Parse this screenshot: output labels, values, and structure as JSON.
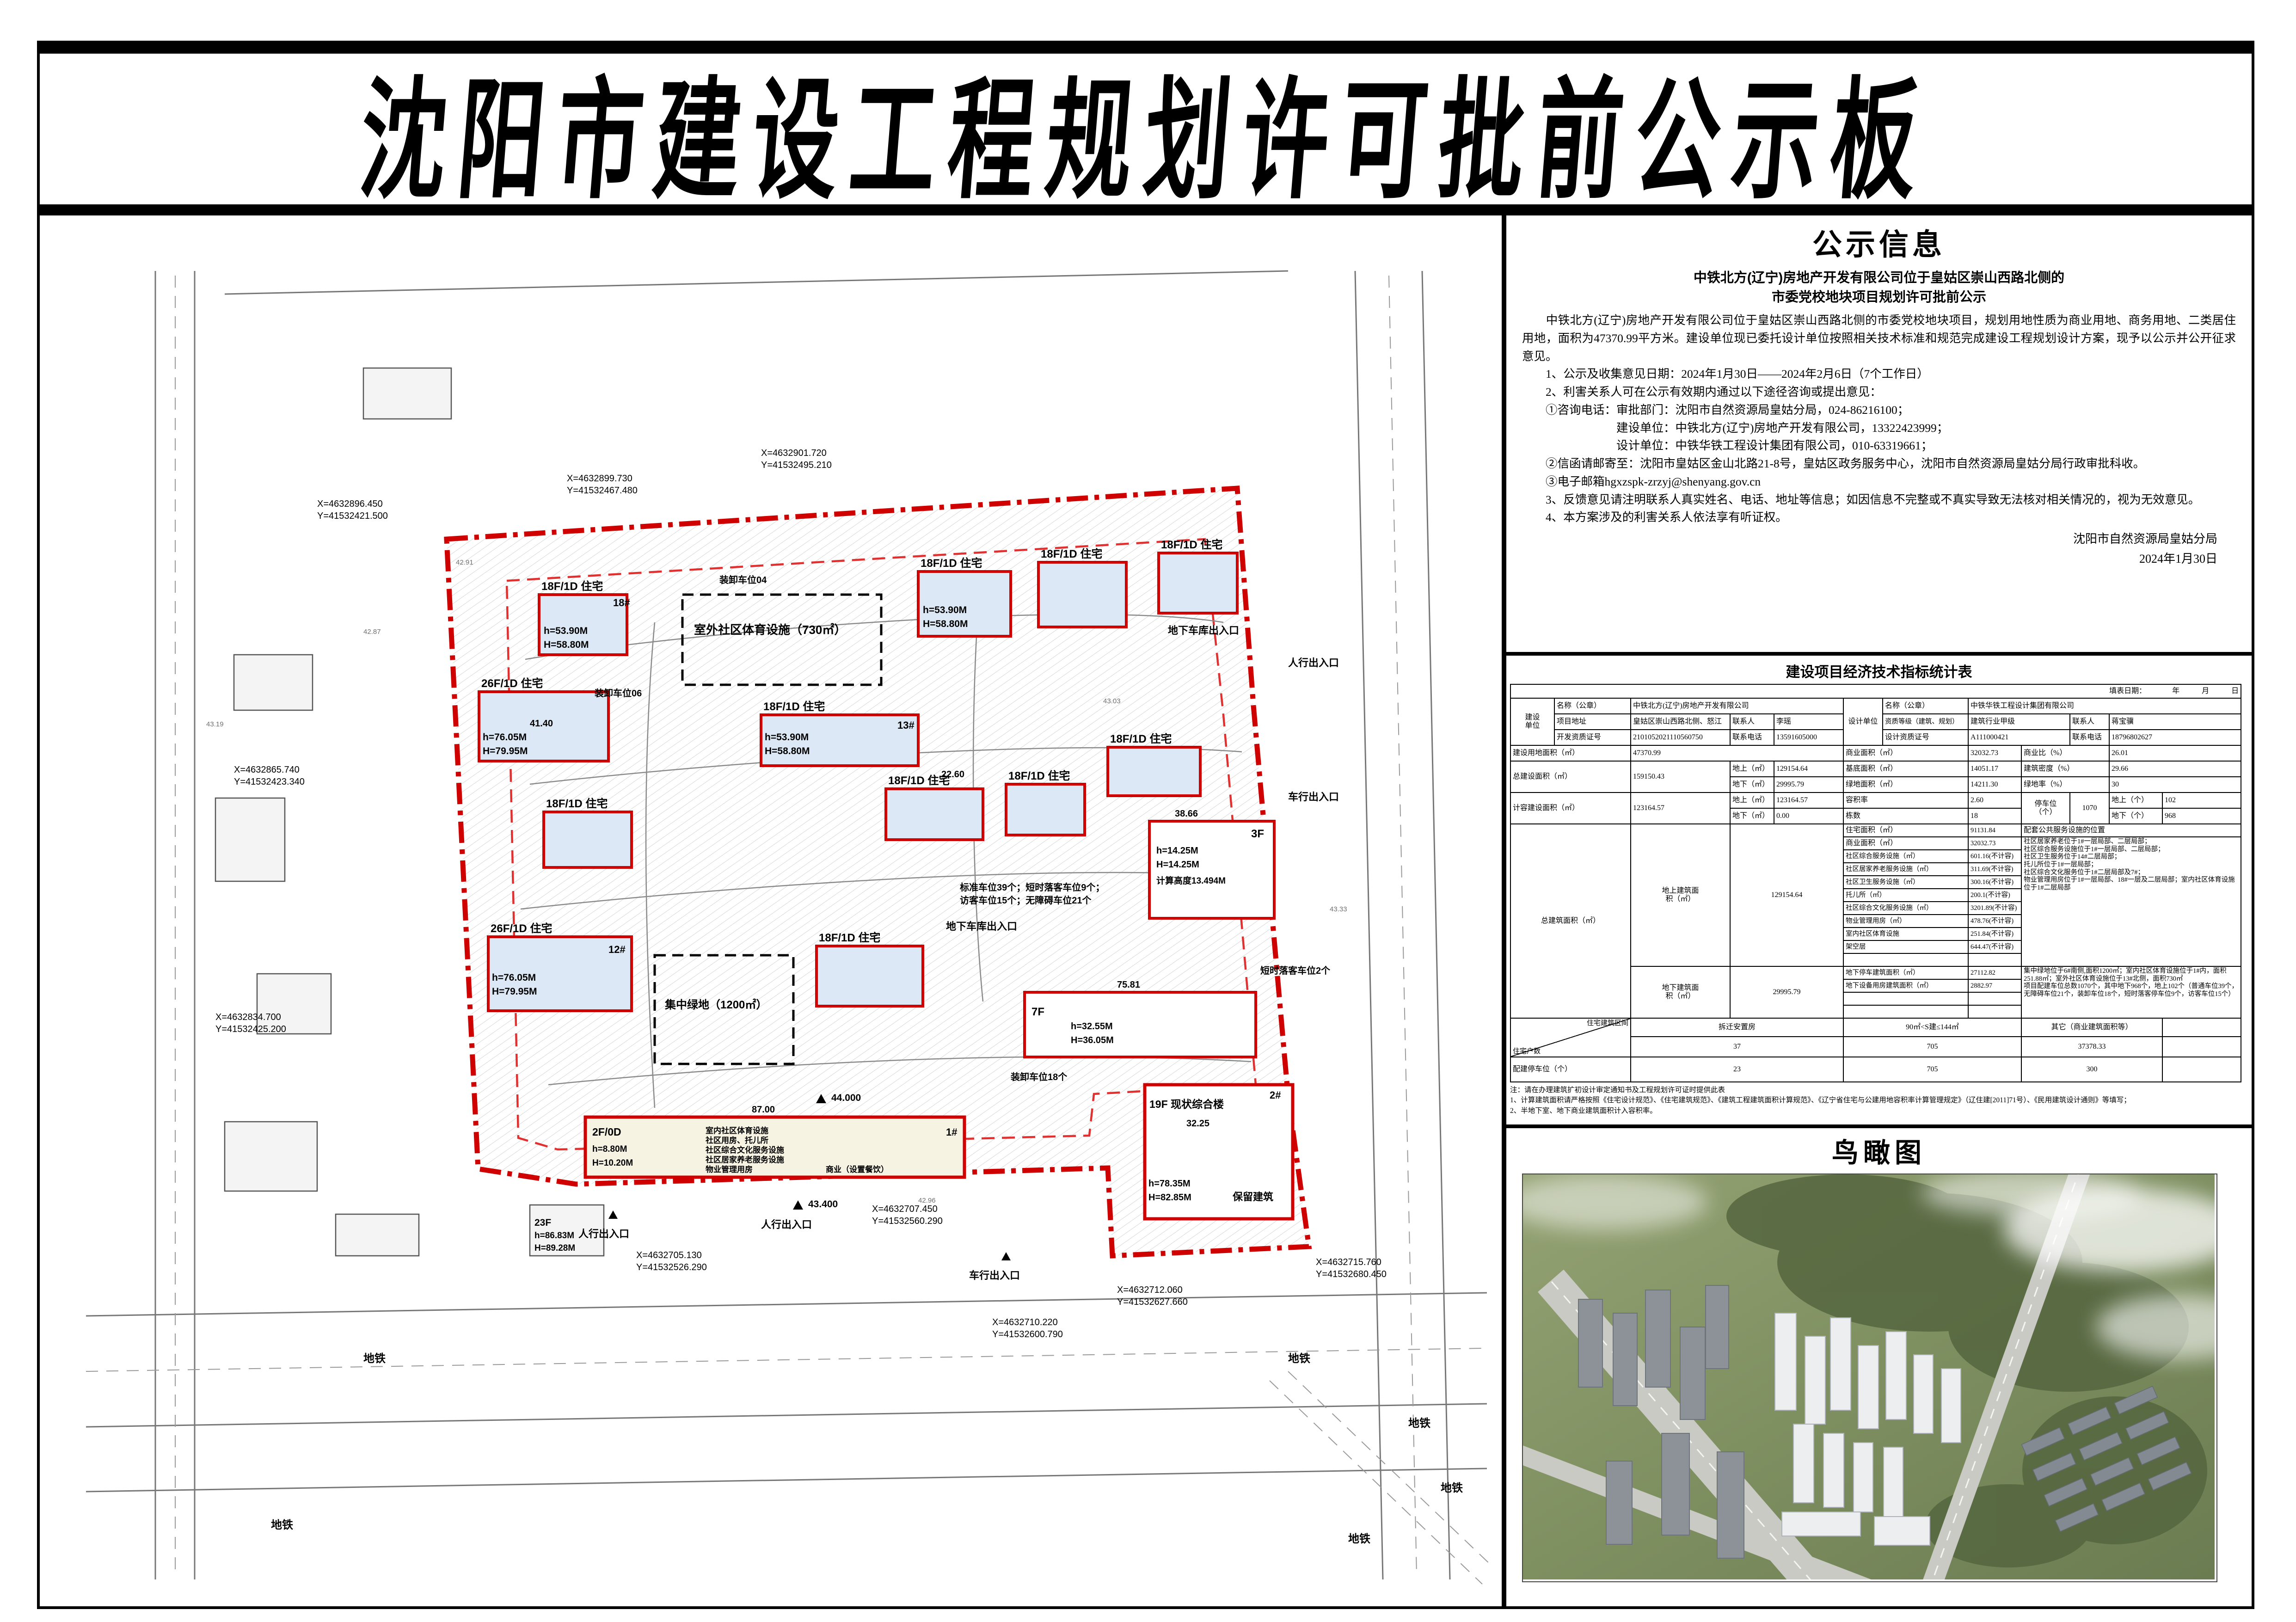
{
  "page": {
    "title": "沈阳市建设工程规划许可批前公示板"
  },
  "notice": {
    "title": "公示信息",
    "subtitle1": "中铁北方(辽宁)房地产开发有限公司位于皇姑区崇山西路北侧的",
    "subtitle2": "市委党校地块项目规划许可批前公示",
    "paragraphs": [
      "　　中铁北方(辽宁)房地产开发有限公司位于皇姑区崇山西路北侧的市委党校地块项目，规划用地性质为商业用地、商务用地、二类居住用地，面积为47370.99平方米。建设单位现已委托设计单位按照相关技术标准和规范完成建设工程规划设计方案，现予以公示并公开征求意见。",
      "　　1、公示及收集意见日期：2024年1月30日——2024年2月6日（7个工作日）",
      "　　2、利害关系人可在公示有效期内通过以下途径咨询或提出意见：",
      "　　①咨询电话：审批部门：沈阳市自然资源局皇姑分局，024-86216100；",
      "　　　　　　　　建设单位：中铁北方(辽宁)房地产开发有限公司，13322423999；",
      "　　　　　　　　设计单位：中铁华铁工程设计集团有限公司，010-63319661；",
      "　　②信函请邮寄至：沈阳市皇姑区金山北路21-8号，皇姑区政务服务中心，沈阳市自然资源局皇姑分局行政审批科收。",
      "　　③电子邮箱hgxzspk-zrzyj@shenyang.gov.cn",
      "　　3、反馈意见请注明联系人真实姓名、电话、地址等信息；如因信息不完整或不真实导致无法核对相关情况的，视为无效意见。",
      "　　4、本方案涉及的利害关系人依法享有听证权。"
    ],
    "signature": "沈阳市自然资源局皇姑分局",
    "date": "2024年1月30日"
  },
  "table": {
    "title": "建设项目经济技术指标统计表",
    "fill_date": "填表日期：　　　　年　　　月　　　日",
    "builder": {
      "label": "建设\n单位",
      "name_label": "名称（公章）",
      "name": "中铁北方(辽宁)房地产开发有限公司",
      "addr_label": "项目地址",
      "addr": "皇姑区崇山西路北侧、怒江",
      "contact_label": "联系人",
      "contact": "李瑶",
      "cert_label": "开发资质证号",
      "cert": "2101052021110560750",
      "phone_label": "联系电话",
      "phone": "13591605000"
    },
    "designer": {
      "label": "设计单位",
      "name_label": "名称（公章）",
      "name": "中铁华铁工程设计集团有限公司",
      "grade_label": "资质等级（建筑、规划）",
      "grade": "建筑行业甲级",
      "contact_label": "联系人",
      "contact": "蒋宝骥",
      "cert_label": "设计资质证号",
      "cert": "A111000421",
      "phone_label": "联系电话",
      "phone": "18796802627"
    },
    "land": {
      "label": "建设用地面积（㎡）",
      "value": "47370.99",
      "biz_label": "商业面积（㎡）",
      "biz": "32032.73",
      "ratio_label": "商业比（%）",
      "ratio": "26.01"
    },
    "total": {
      "label": "总建设面积（㎡）",
      "value": "159150.43",
      "up_label": "地上（㎡）",
      "up": "129154.64",
      "base_label": "基底面积（㎡）",
      "base": "14051.17",
      "density_label": "建筑密度（%）",
      "density": "29.66",
      "down_label": "地下（㎡）",
      "down": "29995.79",
      "green_label": "绿地面积（㎡）",
      "green": "14211.30",
      "green_rate_label": "绿地率（%）",
      "green_rate": "30"
    },
    "frc": {
      "label": "计容建设面积（㎡）",
      "value": "123164.57",
      "up_label": "地上（㎡）",
      "up": "123164.57",
      "far_label": "容积率",
      "far": "2.60",
      "park_label": "停车位\n（个）",
      "park": "1070",
      "pu_label": "地上（个）",
      "pu": "102",
      "down_label": "地下（㎡）",
      "down": "0.00",
      "cnt_label": "栋数",
      "cnt": "18",
      "pd_label": "地下（个）",
      "pd": "968"
    },
    "gfa": {
      "label": "总建筑面积（㎡）",
      "above_label": "地上建筑面\n积（㎡）",
      "above": "129154.64",
      "below_label": "地下建筑面\n积（㎡）",
      "below": "29995.79"
    },
    "above_items": [
      {
        "n": "住宅面积（㎡）",
        "v": "91131.84"
      },
      {
        "n": "商业面积（㎡）",
        "v": "32032.73"
      },
      {
        "n": "社区综合服务设施（㎡）",
        "v": "601.16(不计容)"
      },
      {
        "n": "社区居家养老服务设施（㎡）",
        "v": "311.69(不计容)"
      },
      {
        "n": "社区卫生服务设施（㎡）",
        "v": "300.16(不计容)"
      },
      {
        "n": "托儿所（㎡）",
        "v": "200.1(不计容)"
      },
      {
        "n": "社区综合文化服务设施（㎡）",
        "v": "3201.89(不计容)"
      },
      {
        "n": "物业管理用房（㎡）",
        "v": "478.76(不计容)"
      },
      {
        "n": "室内社区体育设施",
        "v": "251.84(不计容)"
      },
      {
        "n": "架空层",
        "v": "644.47(不计容)"
      },
      {
        "n": "",
        "v": ""
      }
    ],
    "below_items": [
      {
        "n": "地下停车建筑面积（㎡）",
        "v": "27112.82"
      },
      {
        "n": "地下设备用房建筑面积（㎡）",
        "v": "2882.97"
      },
      {
        "n": "",
        "v": ""
      },
      {
        "n": "",
        "v": ""
      }
    ],
    "services_title": "配套公共服务设施的位置",
    "services_text1": "社区居家养老位于1#一层局部、二层局部；\n社区综合服务设施位于1#一层局部、二层局部；\n社区卫生服务位于14#二层局部；\n托儿所位于1#一层局部；\n社区综合文化服务位于1#二层局部及7#；\n物业管理用房位于1#一层局部、18#一层及二层局部；室内社区体育设施位于1#二层局部",
    "services_text2": "集中绿地位于6#南侧,面积1200㎡；室内社区体育设施位于1#内，面积251.88㎡；室外社区体育设施位于13#北侧，面积730㎡\n项目配建车位总数1070个，其中地下968个，地上102个（普通车位39个，无障碍车位21个，装卸车位18个，短时落客停车位9个，访客车位15个）",
    "bottom": {
      "hu_label": "住宅户数",
      "qujian_label": "住宅建筑区间",
      "chaiqian": "拆迁安置房",
      "range": "90㎡<S建≤144㎡",
      "other": "其它（商业建筑面积等）",
      "hu_v1": "37",
      "hu_v2": "705",
      "hu_v3": "37378.33",
      "park_label": "配建停车位（个）",
      "pk_v1": "23",
      "pk_v2": "705",
      "pk_v3": "300"
    },
    "notes": "注：请在办理建筑扩初设计审定通知书及工程规划许可证时提供此表\n1、计算建筑面积请严格按照《住宅设计规范》、《住宅建筑规范》、《建筑工程建筑面积计算规范》、《辽宁省住宅与公建用地容积率计算管理规定》（辽住建[2011]71号）、《民用建筑设计通则》等填写；\n2、半地下室、地下商业建筑面积计入容积率。"
  },
  "plan": {
    "b18": "18F/1D 住宅",
    "b26": "26F/1D 住宅",
    "h18": "h=53.90M",
    "H18": "H=58.80M",
    "h26": "h=76.05M",
    "H26": "H=79.95M",
    "no18": "18#",
    "no13": "13#",
    "no12": "12#",
    "no1": "1#",
    "no2": "2#",
    "b3f": "3F",
    "h3f": "h=14.25M",
    "H3f": "H=14.25M",
    "calc3f": "计算高度13.494M",
    "b7f": "7F",
    "h7f": "h=32.55M",
    "H7f": "H=36.05M",
    "b19f": "19F 现状综合楼",
    "h19f": "h=78.35M",
    "H19f": "H=82.85M",
    "keep": "保留建筑",
    "b2f": "2F/0D",
    "h2f": "h=8.80M",
    "H2f": "H=10.20M",
    "b23f": "23F",
    "h23f": "h=86.83M",
    "H23f": "H=89.28M",
    "svc": [
      "室内社区体育设施",
      "社区用房、托儿所",
      "社区综合文化服务设施",
      "社区居家养老服务设施",
      "物业管理用房",
      "商业（设置餐饮）"
    ],
    "sport": "室外社区体育设施（730㎡）",
    "green": "集中绿地（1200㎡）",
    "ped": "人行出入口",
    "veh": "车行出入口",
    "garage": "地下车库出入口",
    "metro": "地铁",
    "pk1": "标准车位39个；短时落客车位9个；",
    "pk2": "访客车位15个；无障碍车位21个",
    "zx04": "装卸车位04",
    "zx06": "装卸车位06",
    "zx18": "装卸车位18个",
    "dsk": "短时落客车位2个",
    "lv1": "44.000",
    "lv2": "43.400",
    "d87": "87.00",
    "d4140": "41.40",
    "d7581": "75.81",
    "d3225": "32.25",
    "d3866": "38.66",
    "d2260": "22.60",
    "c1x": "X=4632896.450",
    "c1y": "Y=41532421.500",
    "c2x": "X=4632899.730",
    "c2y": "Y=41532467.480",
    "c3x": "X=4632901.720",
    "c3y": "Y=41532495.210",
    "c4x": "X=4632865.740",
    "c4y": "Y=41532423.340",
    "c5x": "X=4632834.700",
    "c5y": "Y=41532425.200",
    "c6x": "X=4632705.130",
    "c6y": "Y=41532526.290",
    "c7x": "X=4632707.450",
    "c7y": "Y=41532560.290",
    "c8x": "X=4632710.220",
    "c8y": "Y=41532600.790",
    "c9x": "X=4632712.060",
    "c9y": "Y=41532627.660",
    "c10x": "X=4632715.760",
    "c10y": "Y=41532680.450",
    "e1": "42.91",
    "e2": "42.87",
    "e3": "43.19",
    "e4": "42.96",
    "e5": "43.03",
    "e6": "43.33"
  },
  "bird": {
    "title": "鸟瞰图"
  }
}
